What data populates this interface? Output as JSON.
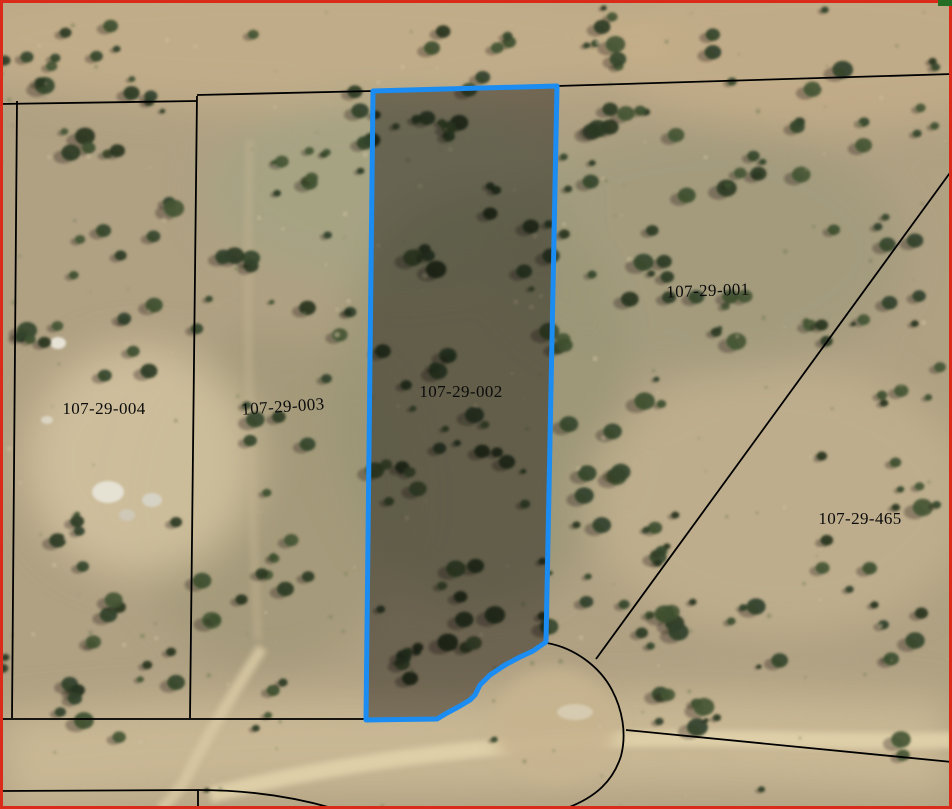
{
  "map": {
    "description": "Aerial parcel map with highlighted selected parcel",
    "selected_parcel": "107-29-002",
    "parcels": [
      {
        "apn": "107-29-004",
        "label": {
          "x": 104,
          "y": 409,
          "rotation": 0
        },
        "selected": false
      },
      {
        "apn": "107-29-003",
        "label": {
          "x": 283,
          "y": 407,
          "rotation": -4
        },
        "selected": false
      },
      {
        "apn": "107-29-002",
        "label": {
          "x": 461,
          "y": 392,
          "rotation": 0
        },
        "selected": true
      },
      {
        "apn": "107-29-001",
        "label": {
          "x": 708,
          "y": 291,
          "rotation": -2
        },
        "selected": false
      },
      {
        "apn": "107-29-465",
        "label": {
          "x": 860,
          "y": 519,
          "rotation": 0
        },
        "selected": false
      }
    ],
    "selected_outline_path": "M373,91 L557,86 L546,642 L533,651 L520,657 L505,665 L490,675 L480,685 L475,695 L470,700 L460,706 L447,713 L437,719 L366,720 Z",
    "boundary_paths": [
      "M0,104 L197,101",
      "M197,95 L373,91",
      "M557,86 L952,74",
      "M197,96 L190,718",
      "M17,101 L12,718",
      "M2,719 L369,719",
      "M596,659 L952,170",
      "M626,730 L952,762",
      "M547,643 C575,648 600,667 612,690 C622,709 627,733 621,756 C613,781 596,797 567,808",
      "M0,791 L198,790 L198,809",
      "M198,790 C243,790 290,796 332,808"
    ],
    "extent_border_path": "M1.5,1.5 H950.5 V807.5 H1.5 Z",
    "corner_marker": {
      "x": 938,
      "y": 0,
      "width": 14,
      "height": 6
    },
    "colors": {
      "selected_outline": "#1B8CF2",
      "selected_fill": "rgba(0,0,0,0.38)",
      "parcel_line": "#000000",
      "extent_border": "#D92A1A",
      "label_text": "#0B0B0B",
      "corner_marker": "#256E25"
    }
  }
}
